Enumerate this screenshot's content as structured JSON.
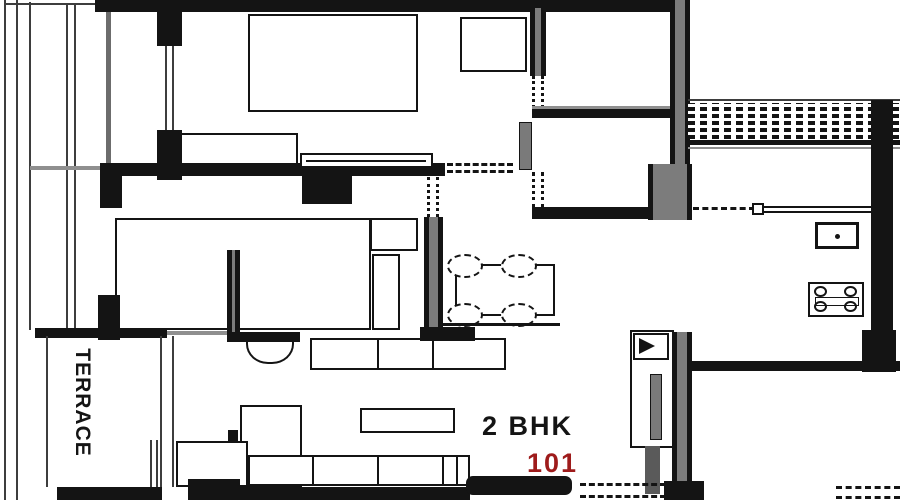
{
  "plan": {
    "terrace_label": "TERRACE",
    "unit_type_label": "2 BHK",
    "unit_number": "101"
  },
  "colors": {
    "walls": "#141414",
    "secondary_lines": "#3d3d3d",
    "wall_core_gray": "#7c7c7c",
    "unit_number_red": "#9e1b1b",
    "background": "#ffffff"
  },
  "icons": [
    "double-bed-icon",
    "wardrobe-icon",
    "dresser-icon",
    "dining-table-icon",
    "dining-chair-icon",
    "sofa-icon",
    "tv-unit-icon",
    "kitchen-sink-icon",
    "gas-stove-icon",
    "wash-basin-icon",
    "door-leaf-icon",
    "door-swing-icon",
    "vent-grille-icon",
    "cupboard-icon"
  ]
}
